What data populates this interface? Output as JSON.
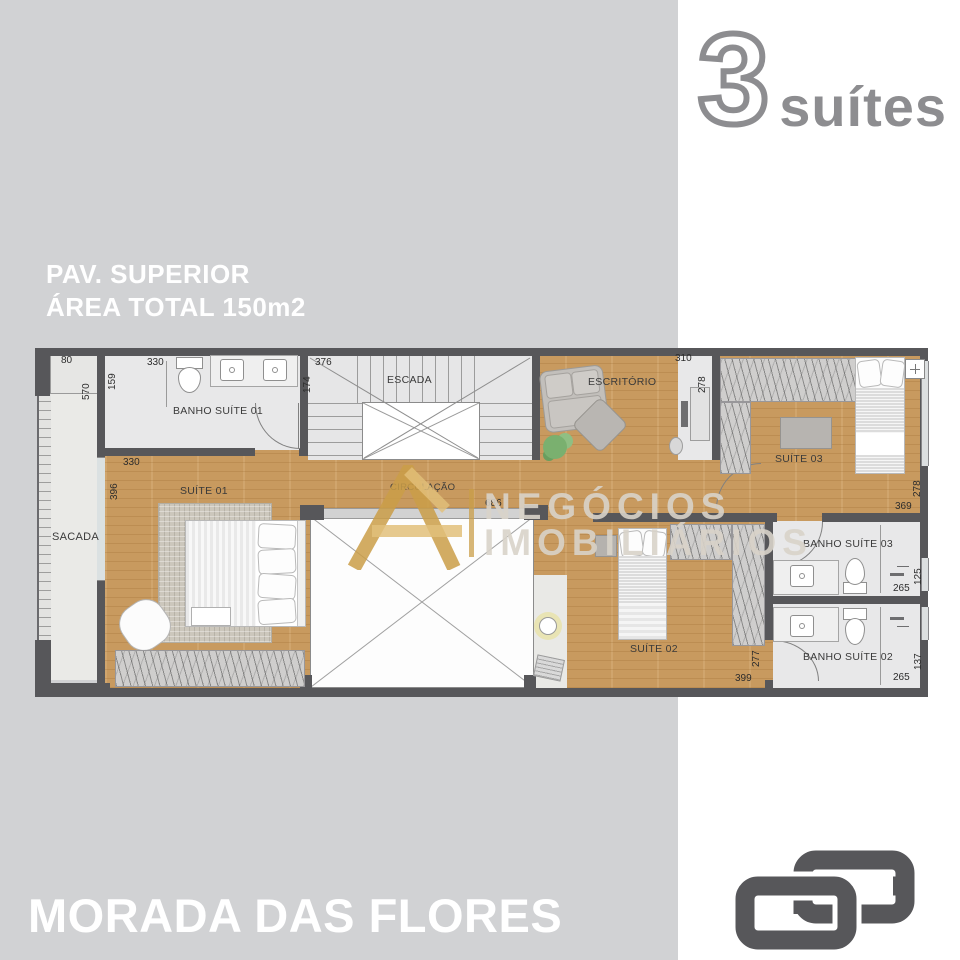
{
  "branding": {
    "number": "3",
    "label": "suítes"
  },
  "header": {
    "line1": "PAV. SUPERIOR",
    "line2": "ÁREA TOTAL 150m2"
  },
  "watermark": {
    "line1": "NEGÓCIOS",
    "line2": "IMOBILIÁRIOS"
  },
  "footer": {
    "title": "MORADA DAS FLORES"
  },
  "plan": {
    "rooms": {
      "banho1": "BANHO SUÍTE 01",
      "escada": "ESCADA",
      "escritorio": "ESCRITÓRIO",
      "suite03": "SUÍTE 03",
      "suite01": "SUÍTE 01",
      "circulacao": "CIRCULAÇÃO",
      "sacada": "SACADA",
      "suite02": "SUÍTE 02",
      "banho3": "BANHO SUÍTE 03",
      "banho2": "BANHO SUÍTE 02"
    },
    "dimensions": [
      "80",
      "570",
      "159",
      "330",
      "376",
      "174",
      "310",
      "278",
      "330",
      "396",
      "686",
      "278",
      "369",
      "125",
      "265",
      "277",
      "399",
      "137",
      "265"
    ]
  },
  "colors": {
    "background_gray": "#d1d2d4",
    "wall": "#57575a",
    "wood": "#c89a5f",
    "brand_gray": "#8d8d90",
    "watermark_gold": "#ca9d48",
    "logo_gray": "#57575a",
    "text_white": "#ffffff"
  }
}
